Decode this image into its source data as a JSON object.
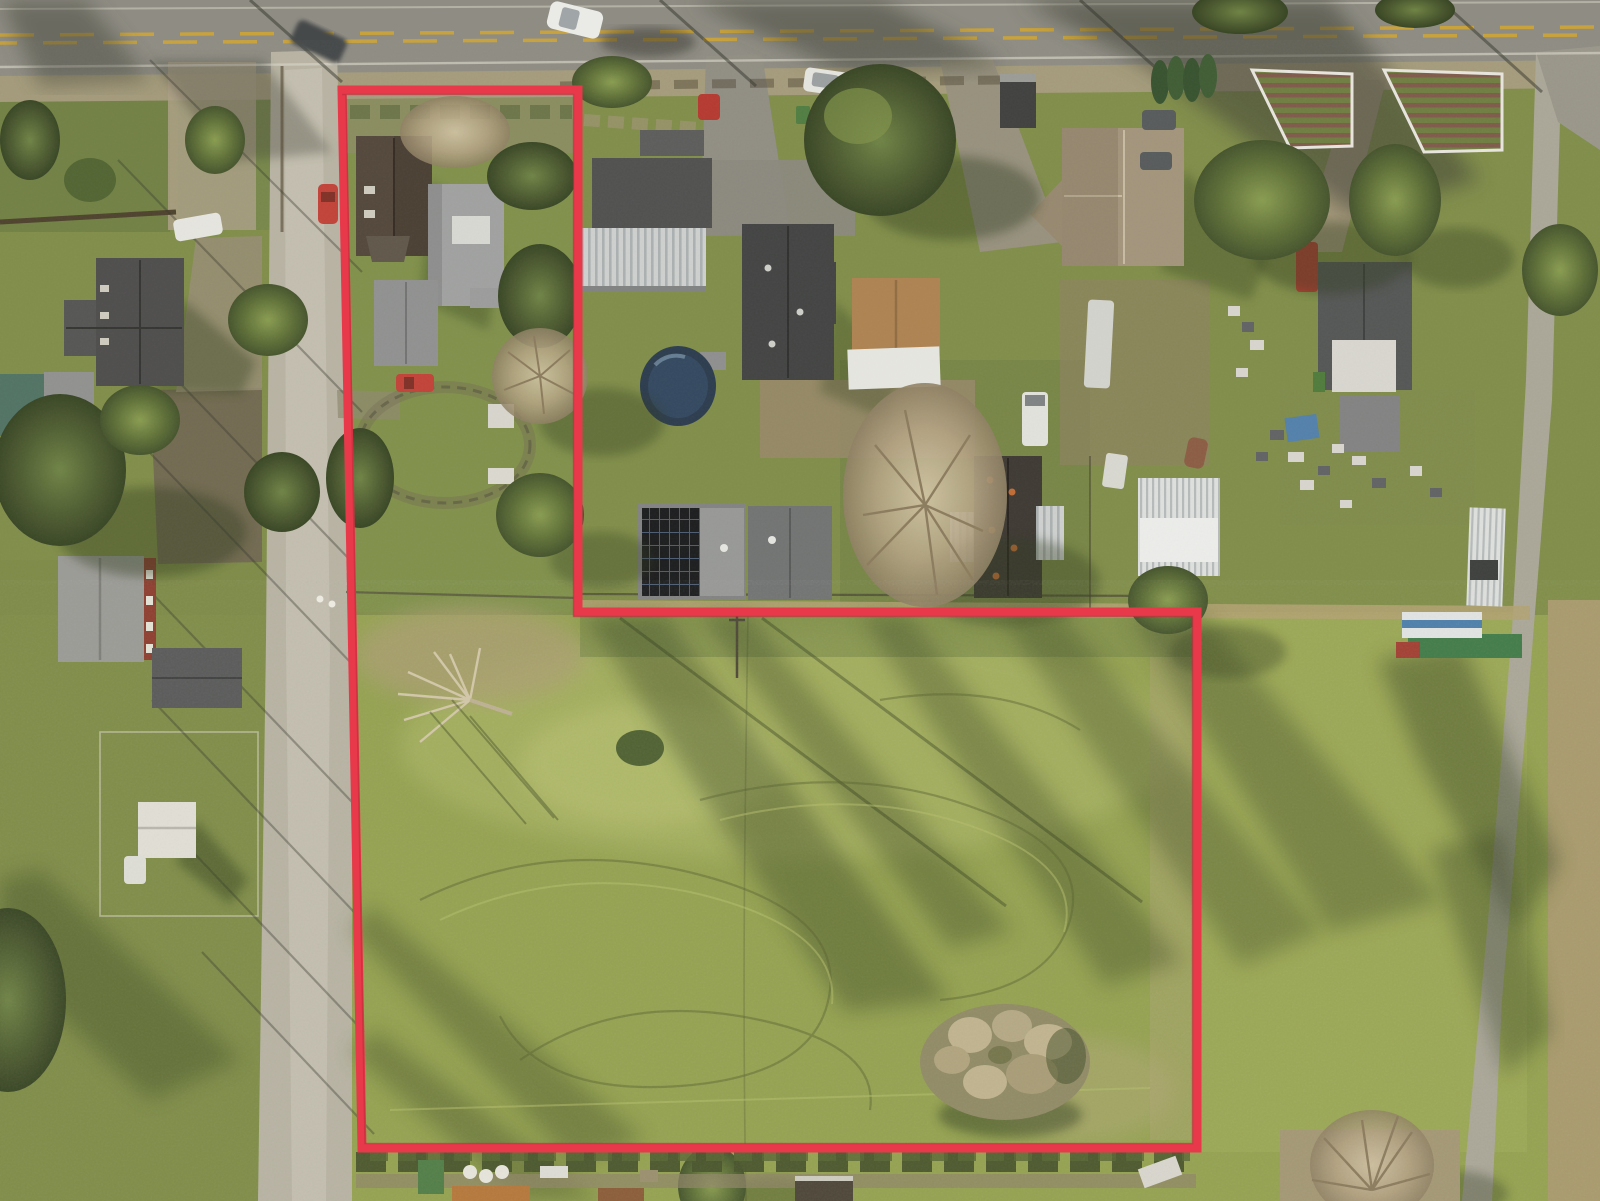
{
  "meta": {
    "title": "Aerial drone photograph of a rural residential parcel with a red property-line outline",
    "width_px": 1600,
    "height_px": 1201
  },
  "boundary": {
    "name": "parcel-outline",
    "color": "#e8394b",
    "stroke_width": 9,
    "points": "342,90 578,90 578,612 1197,612 1197,1148 362,1148",
    "shape": "L-shaped flag lot: house lot at top-left plus large pasture below the neighborhood"
  },
  "palette": {
    "asphalt": "#8d8c85",
    "gravel_road": "#b8b4a6",
    "lane": "#aaa79b",
    "shoulder": "#a89c83",
    "field": "#93a251",
    "field_bright": "#aab566",
    "field_pale": "#ab9f74",
    "yard_green": "#7a8b49",
    "dirt": "#a3977c",
    "soil_dark": "#6e6452",
    "tree_green": "#5f7239",
    "tree_bare": "#b3a384",
    "roof_charcoal": "#3e4042",
    "roof_gray": "#9fa1a3",
    "roof_brown": "#50443b",
    "roof_tan": "#ad8252",
    "metal_white": "#e9eaea",
    "solar_panel": "#17191d",
    "pool_blue": "#2e4560",
    "barn_red": "#8c3b2f",
    "center_line_yellow": "#c8a23c",
    "car_red": "#c23f38",
    "car_white": "#e9eae8",
    "shadow_green": "#2f3c1d"
  },
  "scene": {
    "lighting": "low sun from upper-left, long shadows cast toward lower-right",
    "roads": [
      {
        "name": "highway",
        "position": "across top edge",
        "markings": "double yellow dashed center line, white edge lines"
      },
      {
        "name": "gravel-side-road",
        "position": "vertical along left side"
      },
      {
        "name": "narrow-lane",
        "position": "vertical along right side"
      }
    ],
    "features": [
      "two dwellings and a garage inside the outlined top-left lot",
      "large mowed grass pasture inside the lower outlined area",
      "hay/brush pile in lower-right of pasture",
      "fallen bare tree in upper-left of pasture",
      "above-ground pool behind center house",
      "solar-panel roof on one center house",
      "white-fenced garden beds near top-right",
      "barn with red wall west of the side road",
      "white shed in fenced yard at lower-left",
      "storage containers along the right lane and bottom fence line"
    ],
    "vehicles": [
      "white car driving on highway with motion shadow",
      "white SUV parked off highway",
      "dark car at the intersection",
      "red car parked on side road",
      "red car inside outlined lot",
      "white car at west house",
      "white van and white trailer mid-block",
      "red pickup on right-side lot",
      "two dark sedans by the tan-roof house"
    ]
  }
}
